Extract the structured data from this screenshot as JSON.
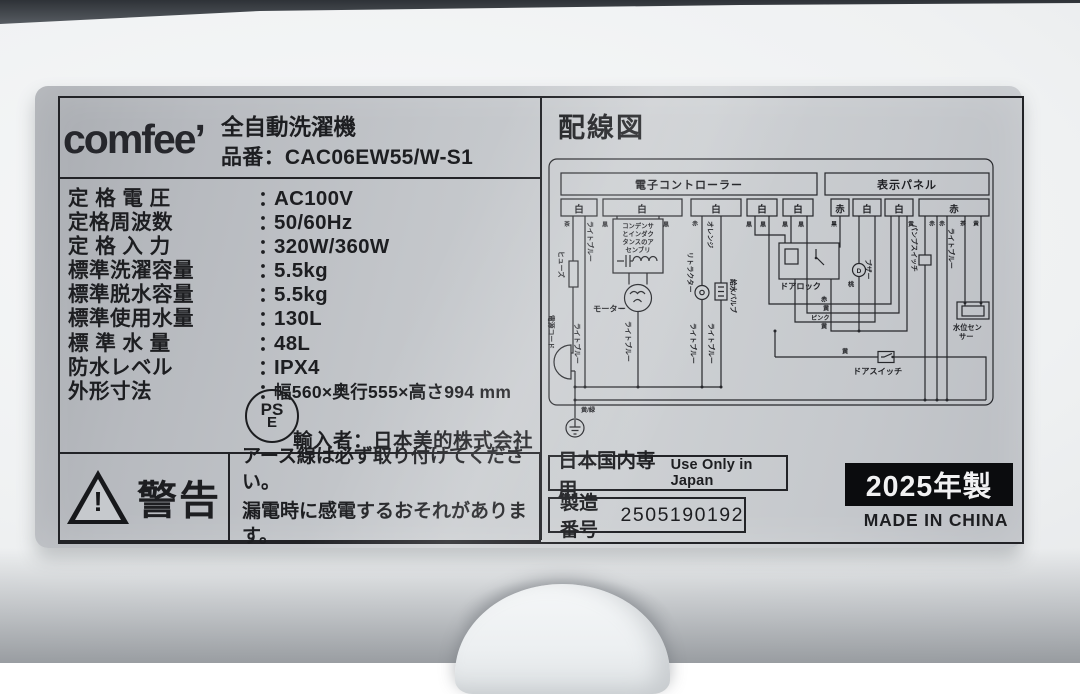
{
  "label": {
    "brand": "comfee’",
    "product_type": "全自動洗濯機",
    "model_name": "品番",
    "sep": "：",
    "model_value": "CAC06EW55/W-S1",
    "specs": [
      {
        "name": "定 格 電 圧",
        "value": "AC100V"
      },
      {
        "name": "定格周波数",
        "value": "50/60Hz"
      },
      {
        "name": "定 格 入 力",
        "value": "320W/360W"
      },
      {
        "name": "標準洗濯容量",
        "value": "5.5kg"
      },
      {
        "name": "標準脱水容量",
        "value": "5.5kg"
      },
      {
        "name": "標準使用水量",
        "value": "130L"
      },
      {
        "name": "標 準 水 量",
        "value": "48L"
      },
      {
        "name": "防水レベル",
        "value": "IPX4"
      },
      {
        "name": "外形寸法",
        "value": "幅560×奥行555×高さ994 mm"
      }
    ],
    "pse_top": "PS",
    "pse_bottom": "E",
    "importer_label": "輸入者",
    "importer_value": "日本美的株式会社",
    "warning_bang": "!",
    "warning_title": "警告",
    "warning_line1": "アース線は必ず取り付けてください。",
    "warning_line2": "漏電時に感電するおそれがあります。",
    "wiring": {
      "title": "配線図",
      "controller": "電子コントローラー",
      "display": "表示パネル",
      "connectors": [
        "白",
        "白",
        "白",
        "白",
        "白",
        "赤",
        "白",
        "白",
        "赤"
      ],
      "colors": {
        "white": "白",
        "red": "赤",
        "black": "黒",
        "brown": "茶",
        "yellow": "黄",
        "pink": "ピンク",
        "peach": "桃",
        "orange": "オレンジ",
        "light_blue": "ライトブルー",
        "ground": "黄/緑"
      },
      "components": {
        "fuse": "ヒューズ",
        "power_cord": "電源コード",
        "assembly1": "コンデンサ",
        "assembly2": "とインダク",
        "assembly3": "タンスのア",
        "assembly4": "センブリ",
        "motor": "モーター",
        "retractor": "リトラクター",
        "water_valve": "給水バルブ",
        "door_lock": "ドアロック",
        "buzzer_letter": "D",
        "buzzer": "ブザー",
        "door_switch": "ドアスイッチ",
        "pump_switch": "パンプスイッチ",
        "water_sensor1": "水位セン",
        "water_sensor2": "サー"
      }
    },
    "footer": {
      "domestic_jp": "日本国内専用",
      "domestic_en": "Use Only in Japan",
      "serial_label": "製造番号",
      "serial_value": "2505190192",
      "year": "2025年製",
      "origin": "MADE IN CHINA"
    }
  }
}
